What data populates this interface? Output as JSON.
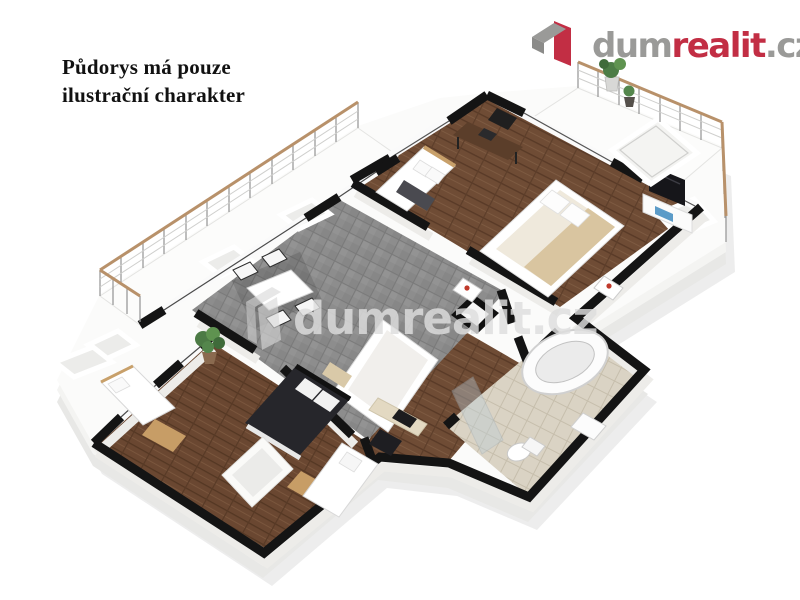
{
  "disclaimer": {
    "line1": "Půdorys má pouze",
    "line2": "ilustrační charakter"
  },
  "logo": {
    "dum": "dum",
    "realit": "realit",
    "cz": ".cz"
  },
  "watermark": {
    "text": "dumrealit.cz"
  },
  "colors": {
    "brand_red": "#c22e44",
    "brand_gray": "#9a9a98",
    "disclaimer_text": "#111111",
    "wall_top": "#141414",
    "wood_floor": "#6f4c35",
    "tile_gray": "#8d8d8d",
    "bath_tile": "#dad3c4",
    "railing_wood": "#b8916a",
    "watermark_gray": "#dedede"
  }
}
